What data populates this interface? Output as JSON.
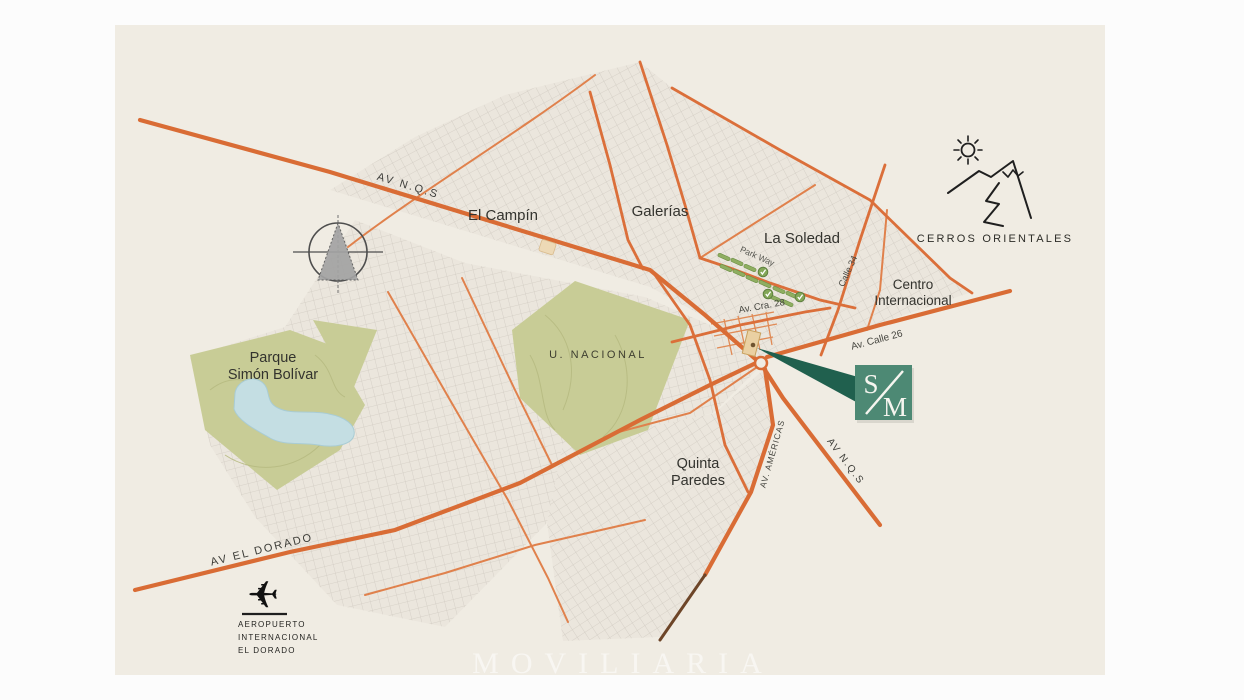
{
  "map": {
    "background": "#f0ece3",
    "watermark": "MOVILIARIA",
    "labels": {
      "av_nqs_north": "AV N.Q.S",
      "el_campin": "El Campín",
      "galerias": "Galerías",
      "la_soledad": "La Soledad",
      "park_way": "Park Way",
      "calle_34": "Calle 34",
      "centro_internacional": "Centro\nInternacional",
      "av_cra_28": "Av. Cra. 28",
      "av_calle_26": "Av. Calle 26",
      "cerros_orientales": "CERROS ORIENTALES",
      "parque_simon_bolivar": "Parque\nSimón Bolívar",
      "u_nacional": "U. NACIONAL",
      "quinta_paredes": "Quinta\nParedes",
      "av_americas": "AV. AMÉRICAS",
      "av_nqs_south": "AV N.Q.S",
      "av_el_dorado": "AV EL DORADO",
      "aeropuerto": "AEROPUERTO\nINTERNACIONAL\nEL DORADO"
    },
    "marker": {
      "letter_top": "S",
      "letter_bottom": "M"
    },
    "icons": {
      "compass": "compass-icon",
      "cerros": "mountains-sun-icon",
      "airport": "airplane-icon",
      "park_way_trees": "tree-check-icon"
    },
    "colors": {
      "map_background": "#f0ece3",
      "road_primary": "#d96c35",
      "road_medium": "#db6f3a",
      "road_minor": "#e0814c",
      "road_dark": "#6d4528",
      "park": "#c8cc96",
      "lake": "#c4dee3",
      "marker_green": "#4d8974",
      "pointer_green": "#20604e",
      "parkway_green": "#8fae61"
    }
  }
}
